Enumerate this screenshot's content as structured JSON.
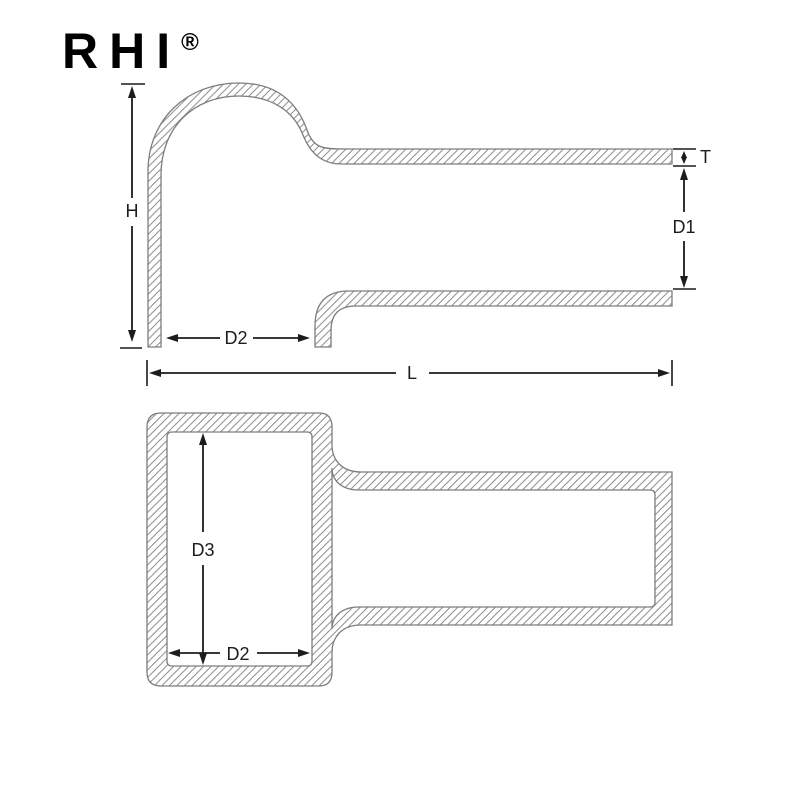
{
  "brand": {
    "name": "RHI",
    "registered_mark": "®"
  },
  "drawing": {
    "description": "Cross-section dimension drawing of a right-angle vinyl terminal cap: side section view (top) and plan section view (bottom)",
    "side_view": {
      "labels": {
        "height": "H",
        "wall_thickness": "T",
        "tube_inner_diameter": "D1",
        "opening_depth": "D2",
        "overall_length": "L"
      }
    },
    "plan_view": {
      "labels": {
        "body_inner_length": "D3",
        "body_inner_width": "D2"
      }
    },
    "colors": {
      "background": "#ffffff",
      "part_outline": "#7d7d7d",
      "hatch_lines": "#909090",
      "dimension_lines": "#1c1c1c",
      "logo": "#000000"
    }
  }
}
